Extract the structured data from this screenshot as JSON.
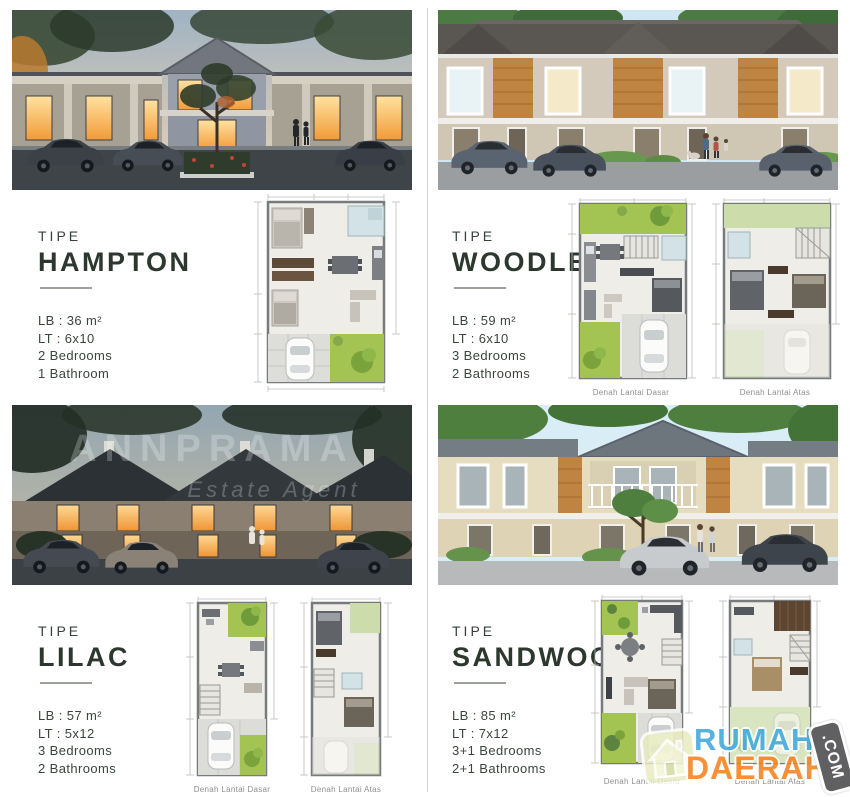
{
  "units": [
    {
      "tipe_label": "TIPE",
      "name": "HAMPTON",
      "lb": "LB : 36 m²",
      "lt": "LT : 6x10",
      "bedrooms": "2 Bedrooms",
      "bathrooms": "1 Bathroom",
      "captions": []
    },
    {
      "tipe_label": "TIPE",
      "name": "WOODLEA",
      "lb": "LB : 59 m²",
      "lt": "LT : 6x10",
      "bedrooms": "3 Bedrooms",
      "bathrooms": "2 Bathrooms",
      "captions": [
        "Denah Lantai Dasar",
        "Denah Lantai Atas"
      ]
    },
    {
      "tipe_label": "TIPE",
      "name": "LILAC",
      "lb": "LB : 57 m²",
      "lt": "LT : 5x12",
      "bedrooms": "3 Bedrooms",
      "bathrooms": "2 Bathrooms",
      "captions": [
        "Denah Lantai Dasar",
        "Denah Lantai Atas"
      ]
    },
    {
      "tipe_label": "TIPE",
      "name": "SANDWOOD",
      "lb": "LB : 85 m²",
      "lt": "LT : 7x12",
      "bedrooms": "3+1 Bedrooms",
      "bathrooms": "2+1 Bathrooms",
      "captions": [
        "Denah Lantai Dasar",
        "Denah Lantai Atas"
      ]
    }
  ],
  "developer_watermark": {
    "line1": "ANNPRAMA",
    "line2": "Estate Agent"
  },
  "brand_watermark": {
    "line1": "RUMAH",
    "line2": "DAERAH",
    "badge": ".COM",
    "colors": {
      "line1": "#3FA9DC",
      "line2": "#F5821F",
      "badge_bg": "#4B4B4D",
      "house_tile": "#E7EBBE"
    }
  }
}
